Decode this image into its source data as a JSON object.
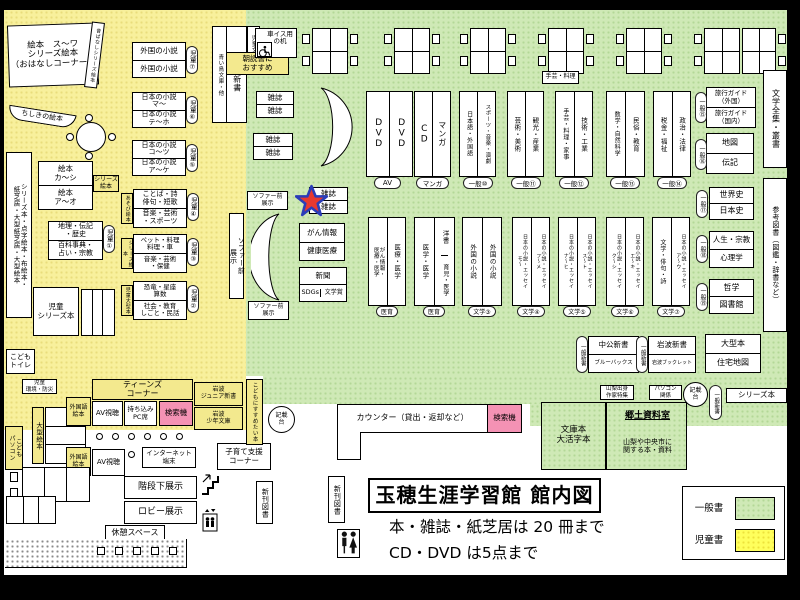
{
  "window": {
    "title": "玉穂生涯学習館 館内図",
    "rule1": "本・雑誌・紙芝居は 20 冊まで",
    "rule2": "CD・DVD は5点まで"
  },
  "legend": {
    "general": "一般書",
    "children": "児童書"
  },
  "colors": {
    "children_yellow": "#f8f09c",
    "general_green": "#cfe9b6",
    "legend_yellow": "#ffff5c",
    "search_pink": "#f492b4",
    "marker_red": "#e8392f",
    "marker_blue": "#2b3db8"
  },
  "children_area": {
    "ohanashi": "絵本　ス〜ワ\nシリーズ絵本\n（おはなしコーナー）",
    "ohanashi_side": "昔ばなしシリーズ絵本",
    "chishiki": "ちしきの絵本",
    "left_strip": "シリーズ本・点字絵本・布絵本・\n紙芝居・大型紙芝居・大型絵本",
    "c7": {
      "top": "外国の小説",
      "bottom": "外国の小説",
      "badge": "児童⑦"
    },
    "c6": {
      "top": "日本の小説\nマ〜",
      "bottom": "日本の小説\nテ〜ホ",
      "badge": "児童⑥"
    },
    "c5": {
      "top": "日本の小説\nコ〜ツ",
      "bottom": "日本の小説\nア〜ケ",
      "badge": "児童⑤"
    },
    "c4": {
      "top": "ことば・詩\n俳句・短歌",
      "bottom": "音楽・芸術\n・スポーツ",
      "badge": "児童④",
      "tag": "あそび絵本"
    },
    "c3": {
      "top": "ペット・料理\n料理・車",
      "bottom": "音楽・芸術\n・保健",
      "badge": "児童③",
      "tag": "シリーズ絵本"
    },
    "c2": {
      "top": "恐竜・星座\n算数",
      "bottom": "社会・教育\nしごと・民話",
      "badge": "児童②",
      "tag": "児童大型本"
    },
    "c1": {
      "top": "地理・伝記\n・歴史",
      "bottom": "百科事典・\n占い・宗教",
      "badge": "児童①"
    },
    "ehon": {
      "top": "絵本\nカ〜シ",
      "bottom": "絵本\nア〜オ",
      "tag": "シリーズ\n絵本"
    },
    "jidou_series": "児童\nシリーズ本",
    "jidou_shinsho": {
      "main": "児童新書",
      "side": "青い鳥文庫・他",
      "tag": "児童文庫"
    },
    "asadoku": "朝読書に\nおすすめ",
    "toilet": "こども\nトイレ",
    "kankyo": "児童\n環境・防災",
    "ogata_ehon": "大型絵本",
    "kodomo_pc": "こども\nパソコン",
    "teens": "ティーンズ\nコーナー",
    "av": "AV視聴",
    "pc_seat": "持ち込み\nPC席",
    "search": "検索機",
    "foreign_ehon": "外国語\n絵本",
    "iwanami_jr": "岩波\nジュニア新書",
    "iwanami_sh": "岩波\n少年文庫",
    "internet": "インターネット\n端末",
    "kosodate": "子育て支援\nコーナー",
    "susume": "こどもにすすめたい本"
  },
  "general_area": {
    "wheel_desk": "車イス用\nの机",
    "zasshi": "雑誌",
    "sofa_front": "ソファー前\n展示",
    "gan_top": "がん情報",
    "gan_bottom": "健康医療",
    "news": "新聞",
    "sdgs": "SDGs",
    "bungakusho": "文学賞",
    "dvd": "DVD",
    "cd": "CD",
    "manga": "マンガ",
    "av_badge": "AV",
    "manga_badge": "マンガ",
    "shugei": "手芸・料理",
    "g10": {
      "left": "日本語・外国語",
      "right": "スポーツ・音楽・演劇",
      "badge": "一般⑩"
    },
    "g11": {
      "left": "芸術・美術",
      "right": "観光・産業",
      "badge": "一般⑪"
    },
    "g12": {
      "left": "手芸・料理・家事",
      "right": "技術・工業",
      "badge": "一般⑫"
    },
    "g13": {
      "left": "数学・自然科学",
      "right": "民俗・教育",
      "badge": "一般⑬"
    },
    "g14": {
      "left": "税金・福祉",
      "right": "政治・法律",
      "badge": "一般⑭"
    },
    "travel": {
      "top": "旅行ガイド\n（外国）",
      "bottom": "旅行ガイド\n（国内）",
      "badge": "一般⑮"
    },
    "chizu": {
      "top": "地図",
      "bottom": "伝記",
      "badge": "一般⑯"
    },
    "zenshu": "文学全集・叢書",
    "hist": {
      "top": "世界史",
      "bottom": "日本史",
      "badge": "一般⑰"
    },
    "jinsei": {
      "top": "人生・宗教",
      "bottom": "心理学",
      "badge": "一般⑱"
    },
    "tetsu": {
      "top": "哲学",
      "bottom": "図書館",
      "badge": "一般⑲"
    },
    "sanko": "参考図書（図鑑・辞書など）",
    "med1": {
      "left": "がん情報・\n医療・医学",
      "right": "医療・医学",
      "badge": "医育"
    },
    "med2": {
      "left": "医学・医学",
      "right_top": "洋書",
      "right_bottom": "育児・医学",
      "badge": "医育"
    },
    "lit3": {
      "left": "外国の小説",
      "right": "外国の小説",
      "badge": "文学③"
    },
    "lit4": {
      "left": "日本の小説・エッセイ\nモ〜",
      "right": "日本の小説・エッセイ\nフ〜メ",
      "badge": "文学④"
    },
    "lit5": {
      "left": "日本の小説・エッセイ\nナ〜ヒ",
      "right": "日本の小説・エッセイ\nス〜ト",
      "badge": "文学⑤"
    },
    "lit6": {
      "left": "日本の小説・エッセイ\nク〜シ",
      "right": "日本の小説・エッセイ\nエ〜キ",
      "badge": "文学⑥"
    },
    "lit7": {
      "left": "文学・俳句・詩",
      "right": "日本の小説・エッセイ\nア〜ウ",
      "badge": "文学⑦"
    },
    "chuko": {
      "top": "中公新書",
      "bottom": "ブルーバックス"
    },
    "iwanami": {
      "top": "岩波新書",
      "bottom": "岩波ブックレット"
    },
    "ogata": {
      "top": "大型本",
      "bottom": "住宅地図"
    },
    "shinsho_badge": "一般新書",
    "yamanashi": "山梨出身\n作家特集",
    "pc_kankei": "パソコン\n関係",
    "kisaidai": "記載\n台",
    "series_box": "シリーズ本",
    "bunko": "文庫本\n大活字本",
    "kyodo": {
      "title": "郷土資料室",
      "desc": "山梨や中央市に\n関する本・資料"
    },
    "counter": "カウンター（貸出・返却など）",
    "search": "検索機"
  },
  "bottom_area": {
    "kaidan": "階段下展示",
    "lobby": "ロビー展示",
    "kyukei": "休憩スペース",
    "shinkan": "新刊図書"
  }
}
